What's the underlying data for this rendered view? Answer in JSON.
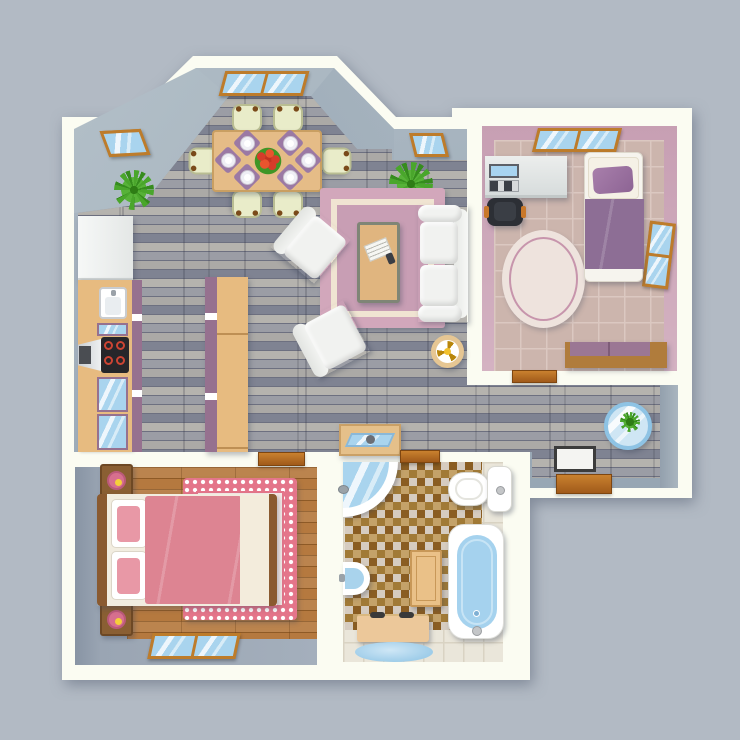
{
  "title": "Apartment floor plan — top view",
  "type": "architectural-floor-plan-illustration",
  "palette": {
    "background": "#b2bac4",
    "wall_white": "#fbfcf2",
    "wall_grey": "#9fadba",
    "wall_pink": "#cfa9bc",
    "floor_stone_grey": "#94969e",
    "floor_tile_pink": "#ccb5ad",
    "floor_tile_cream": "#eae6da",
    "floor_wood": "#b5793f",
    "mosaic_brown": "#a17a36",
    "rug_pink": "#d2a7bb",
    "bed_pink": "#dd8492",
    "bedding_purple": "#8d6e95",
    "counter_tan": "#e7bb80",
    "cabinet_purple": "#96718f",
    "water_blue": "#a9d4ee",
    "window_frame": "#bd7c2b",
    "plant_green": "#4aa62c"
  },
  "rooms": [
    {
      "id": "living-dining",
      "label": "Open living / dining area",
      "floor": "grey stone planks",
      "items": [
        "dining table with 6 place settings and red flower centerpiece",
        "6 cream chairs",
        "white sofa",
        "2 white armchairs",
        "coffee table with newspaper",
        "pink area rug",
        "2 green plants",
        "round side table with gold fan",
        "console table with blue tray"
      ]
    },
    {
      "id": "kitchen",
      "label": "Kitchen",
      "floor": "grey stone planks",
      "items": [
        "refrigerator",
        "sink",
        "cooktop with 4 burners",
        "extractor hood",
        "glass-door cabinets",
        "kitchen island"
      ]
    },
    {
      "id": "bedroom-small",
      "label": "Small bedroom / study",
      "floor": "beige tiles",
      "items": [
        "single bed with purple bedding",
        "desk with laptop",
        "black office chair",
        "oval rug",
        "dresser with purple top",
        "wall window",
        "skylight"
      ]
    },
    {
      "id": "bedroom-master",
      "label": "Master bedroom",
      "floor": "wood planks over grey base",
      "items": [
        "double bed with pink duvet",
        "2 nightstands with pink lamps",
        "pink patterned rug",
        "wall window"
      ]
    },
    {
      "id": "bathroom",
      "label": "Bathroom",
      "floor": "brown mosaic with cream tile border",
      "items": [
        "corner shower",
        "washbasin",
        "toilet with tank",
        "bathtub with blue water",
        "wooden bath mat",
        "storage bench",
        "blue oval rug"
      ]
    },
    {
      "id": "hallway",
      "label": "Entry hallway",
      "floor": "grey stone planks",
      "items": [
        "round glass table with plant",
        "white floor mat",
        "brown entry doormat"
      ]
    }
  ],
  "openings": {
    "skylights": 3,
    "wall_windows": 3,
    "door_thresholds": 4
  }
}
